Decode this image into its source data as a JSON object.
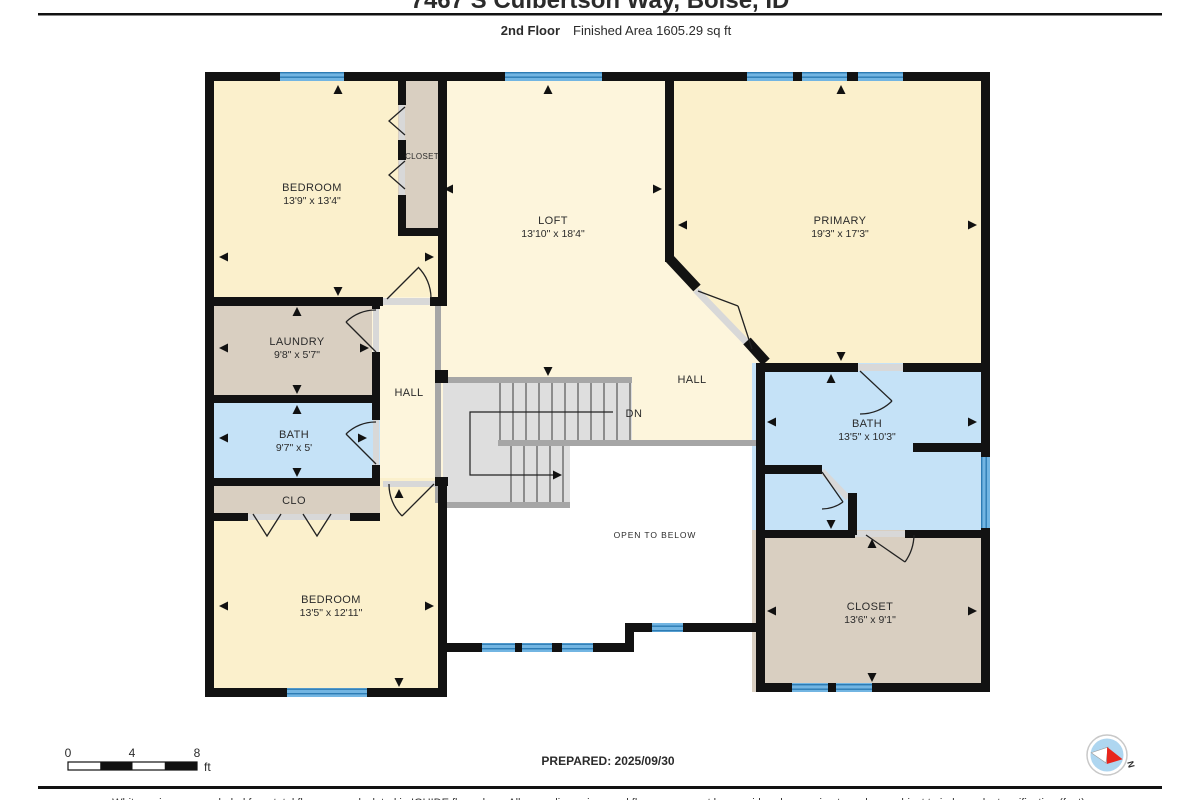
{
  "header": {
    "title": "7467 S Culbertson Way, Boise, ID",
    "floor_label": "2nd Floor",
    "area_label": "Finished Area 1605.29 sq ft"
  },
  "rooms": {
    "bedroom1": {
      "name": "BEDROOM",
      "dims": "13'9\" x 13'4\""
    },
    "closet1": {
      "name": "CLOSET"
    },
    "loft": {
      "name": "LOFT",
      "dims": "13'10\" x 18'4\""
    },
    "primary": {
      "name": "PRIMARY",
      "dims": "19'3\" x 17'3\""
    },
    "laundry": {
      "name": "LAUNDRY",
      "dims": "9'8\" x 5'7\""
    },
    "hall_west": {
      "name": "HALL"
    },
    "hall_east": {
      "name": "HALL"
    },
    "bath_west": {
      "name": "BATH",
      "dims": "9'7\" x 5'"
    },
    "clo": {
      "name": "CLO"
    },
    "bedroom2": {
      "name": "BEDROOM",
      "dims": "13'5\" x 12'11\""
    },
    "bath_primary": {
      "name": "BATH",
      "dims": "13'5\" x 10'3\""
    },
    "closet_primary": {
      "name": "CLOSET",
      "dims": "13'6\" x 9'1\""
    },
    "stairs": {
      "label": "DN"
    },
    "open_to_below": {
      "label": "OPEN TO BELOW"
    }
  },
  "footer": {
    "scale_ticks": [
      "0",
      "4",
      "8"
    ],
    "scale_unit": "ft",
    "prepared_label": "PREPARED: 2025/09/30",
    "compass_north_label": "N",
    "disclaimer": "White regions are excluded from total floor area calculated in IGUIDE floor plans. All room dimensions and floor areas must be considered approximate and are subject to independent verification (feet)."
  },
  "colors": {
    "room_cream": "#fbf0cc",
    "room_cream_light": "#fdf5dc",
    "room_tan": "#d9cfc1",
    "room_blue": "#c5e2f7",
    "window_blue": "#72b5e2",
    "window_stripe": "#2d7cb4",
    "wall": "#121212",
    "stair_fill": "#dedede",
    "stair_edge": "#a6a6a6"
  }
}
